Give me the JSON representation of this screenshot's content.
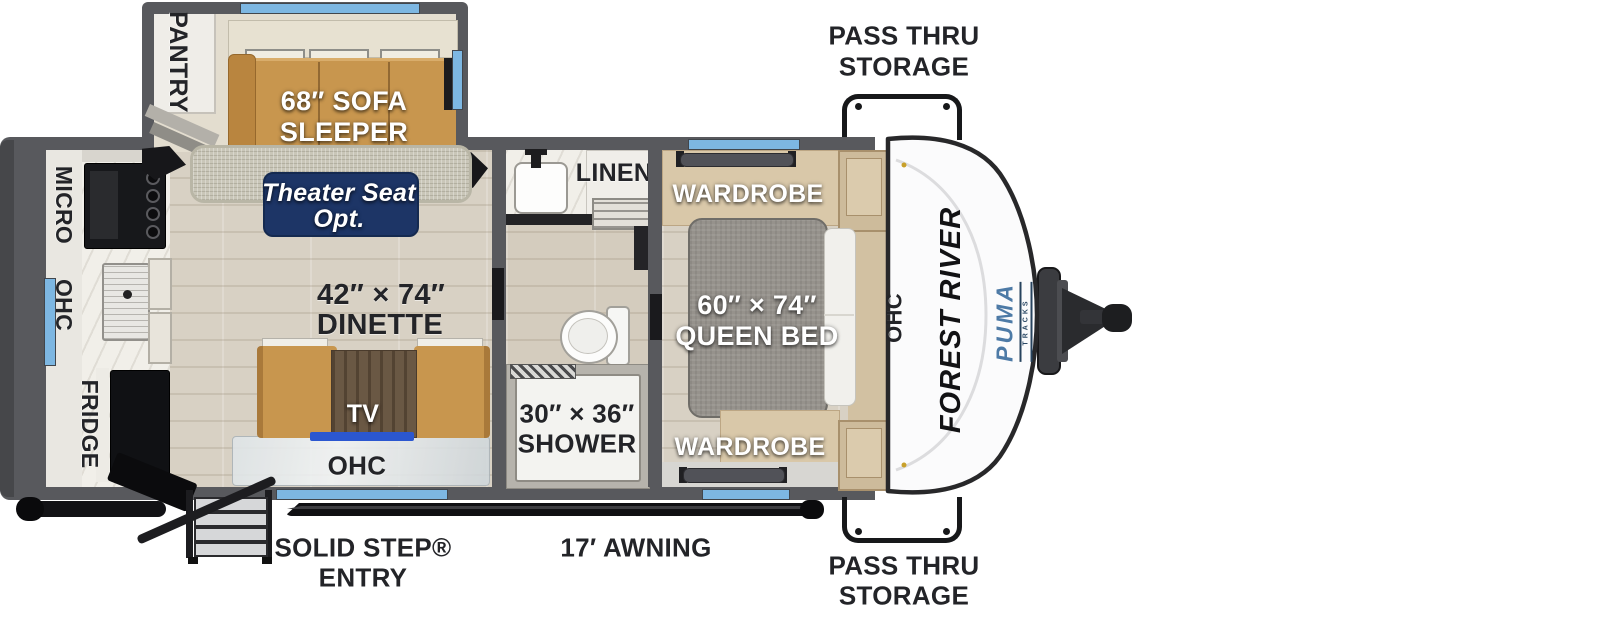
{
  "brand": {
    "manufacturer": "FOREST RIVER",
    "model": "PUMA",
    "series": "TRACKS"
  },
  "exterior": {
    "pass_thru_top": [
      "PASS THRU",
      "STORAGE"
    ],
    "pass_thru_bottom": [
      "PASS THRU",
      "STORAGE"
    ],
    "entry": [
      "SOLID STEP®",
      "ENTRY"
    ],
    "awning": "17′ AWNING"
  },
  "kitchen": {
    "micro": "MICRO",
    "ohc": "OHC",
    "fridge": "FRIDGE"
  },
  "living": {
    "pantry": "PANTRY",
    "sofa": [
      "68″ SOFA",
      "SLEEPER"
    ],
    "theater": [
      "Theater Seat",
      "Opt."
    ],
    "dinette": [
      "42″ × 74″",
      "DINETTE"
    ],
    "tv": "TV",
    "ohc": "OHC"
  },
  "bathroom": {
    "linen": "LINEN",
    "shower": [
      "30″ × 36″",
      "SHOWER"
    ]
  },
  "bedroom": {
    "wardrobe_top": "WARDROBE",
    "wardrobe_bottom": "WARDROBE",
    "bed": [
      "60″ × 74″",
      "QUEEN BED"
    ],
    "ohc": "OHC"
  },
  "colors": {
    "wall": "#58595d",
    "floor": "#d8d1c4",
    "rug": "#c9c6b8",
    "accent_window": "#7db7e2",
    "badge_navy": "#1d3566",
    "puma_blue": "#4d7aa6",
    "sofa_tan": "#c8964e",
    "bed_gray": "#96928c",
    "wardrobe_tan": "#d9c8a9"
  }
}
